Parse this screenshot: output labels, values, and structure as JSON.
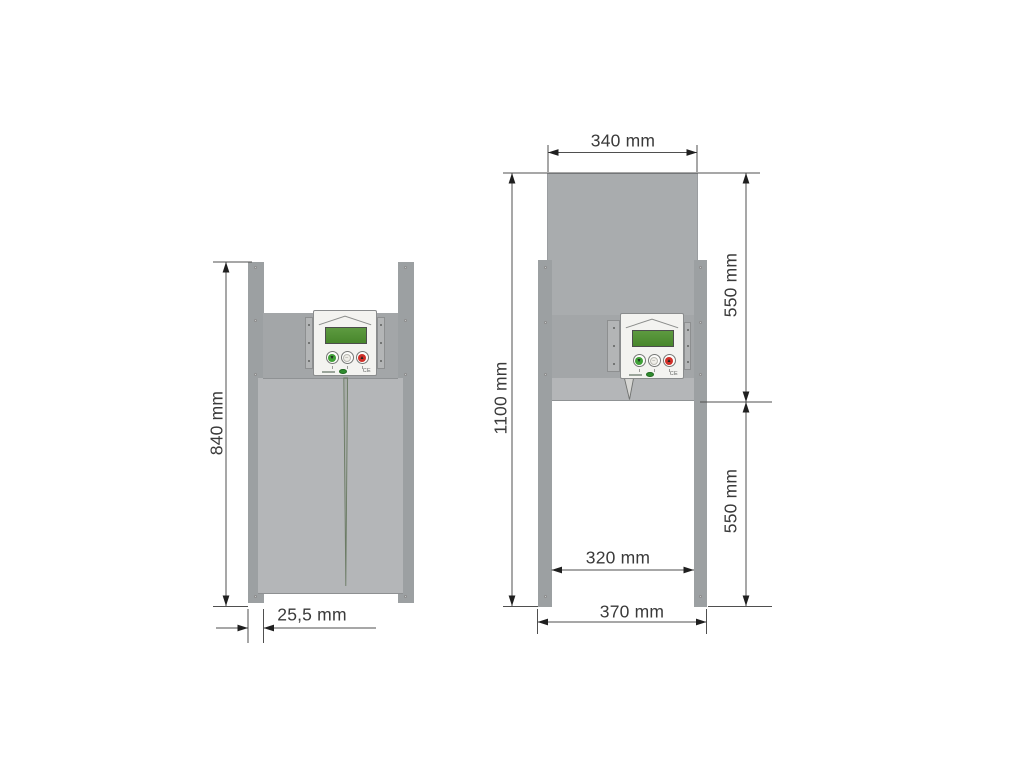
{
  "diagram_subject": "automatic-poultry-door-dimensions",
  "views": {
    "closed": {
      "label": "door-closed-view",
      "dimensions": {
        "height": "840 mm",
        "rail_width": "25,5 mm"
      }
    },
    "open": {
      "label": "door-open-view",
      "dimensions": {
        "door_width": "340 mm",
        "total_height": "1100 mm",
        "upper_section": "550 mm",
        "lower_section": "550 mm",
        "opening_width": "320 mm",
        "outer_width": "370 mm"
      }
    }
  },
  "control_unit": {
    "ce_mark": "CE",
    "icons": {
      "down": "▼",
      "stop": "–",
      "up": "▲"
    },
    "display_color": "#48872c",
    "button_down_color": "#3fa037",
    "button_stop_color": "#efeee8",
    "button_up_color": "#d02f28"
  },
  "colors": {
    "rail": "#9ca0a2",
    "plate": "#a3a6a8",
    "door_closed": "#b4b6b8",
    "door_raised": "#a9acae",
    "dim_line": "#4f4f4f",
    "arrow": "#1f1f1f",
    "text": "#3a3a3a",
    "background": "#ffffff"
  }
}
